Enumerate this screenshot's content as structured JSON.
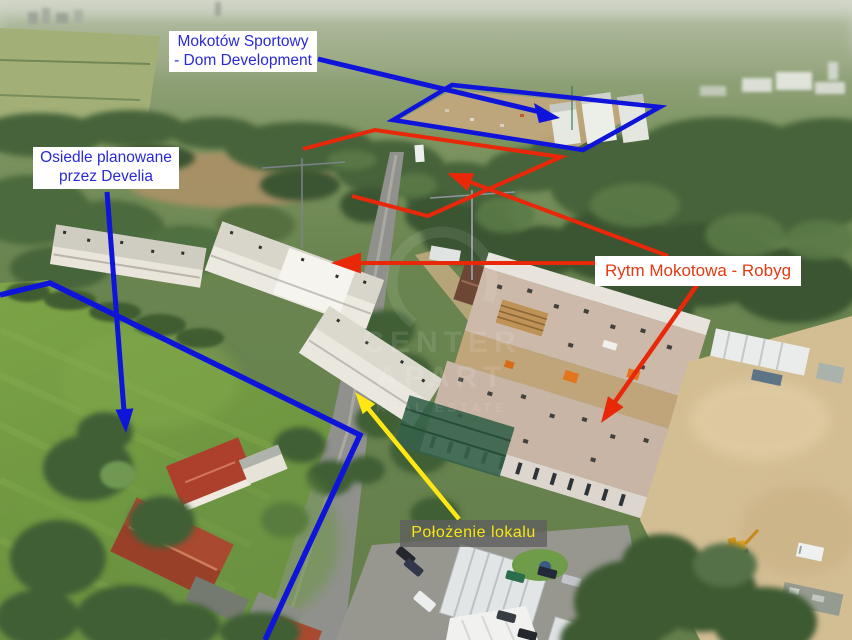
{
  "image": {
    "alt": "Aerial drone photo of a Mokotów residential area with estates under construction and development annotations"
  },
  "annotations": {
    "colors": {
      "blue": "#0f14da",
      "red": "#e92709",
      "yellow": "#ffe715"
    },
    "labels": [
      {
        "name": "mokotow-sportowy",
        "line1": "Mokotów Sportowy",
        "line2": "- Dom Development",
        "text_color": "#2a2ad6",
        "bg": "#ffffff"
      },
      {
        "name": "osiedle-develia",
        "line1": "Osiedle planowane",
        "line2": "przez Develia",
        "text_color": "#2a2ad6",
        "bg": "#ffffff"
      },
      {
        "name": "rytm-mokotowa",
        "text": "Rytm Mokotowa - Robyg",
        "text_color": "#e33a14",
        "bg": "#ffffff"
      },
      {
        "name": "polozenie-lokalu",
        "text": "Położenie lokalu",
        "text_color": "#f8e614",
        "bg": "rgba(95,95,95,0.78)"
      }
    ]
  },
  "watermark": {
    "line1": "CENTER",
    "line2": "APART",
    "line3": "REAL ESTATE"
  }
}
